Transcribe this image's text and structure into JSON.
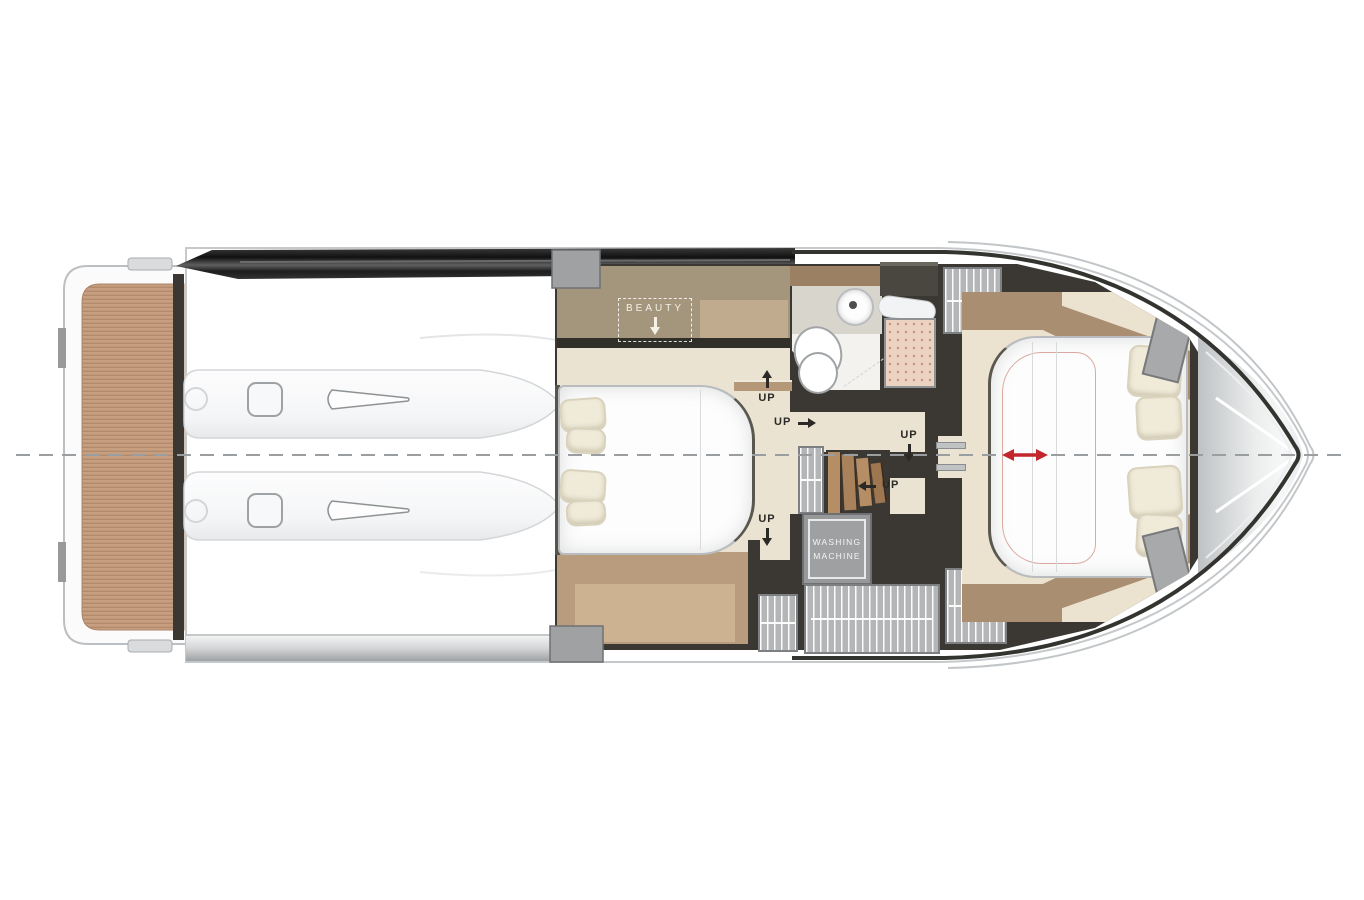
{
  "plan": {
    "kind": "motor-yacht-lower-deck-floor-plan",
    "labels": {
      "beauty": "BEAUTY",
      "up": "UP",
      "washing_line1": "WASHING",
      "washing_line2": "MACHINE"
    },
    "annotations": {
      "up_count": 5,
      "beauty_arrow": "down",
      "up_directions": [
        "up",
        "right",
        "down",
        "left",
        "down"
      ],
      "red_marker": "double-headed-horizontal-arrow"
    }
  },
  "colors": {
    "wall": "#3b3833",
    "floor-beige": "#eae3d1",
    "wood-band": "#a3967d",
    "wood-floor": "#b99c7e",
    "wood-light": "#cdb291",
    "desk-light": "#c0ab8e",
    "bow-wood": "#a98e71",
    "teak": "#c79e80",
    "hatch": "#b3b5b7",
    "red": "#c1272d",
    "line": "#9b9ea0",
    "cream": "#f0ead9"
  }
}
